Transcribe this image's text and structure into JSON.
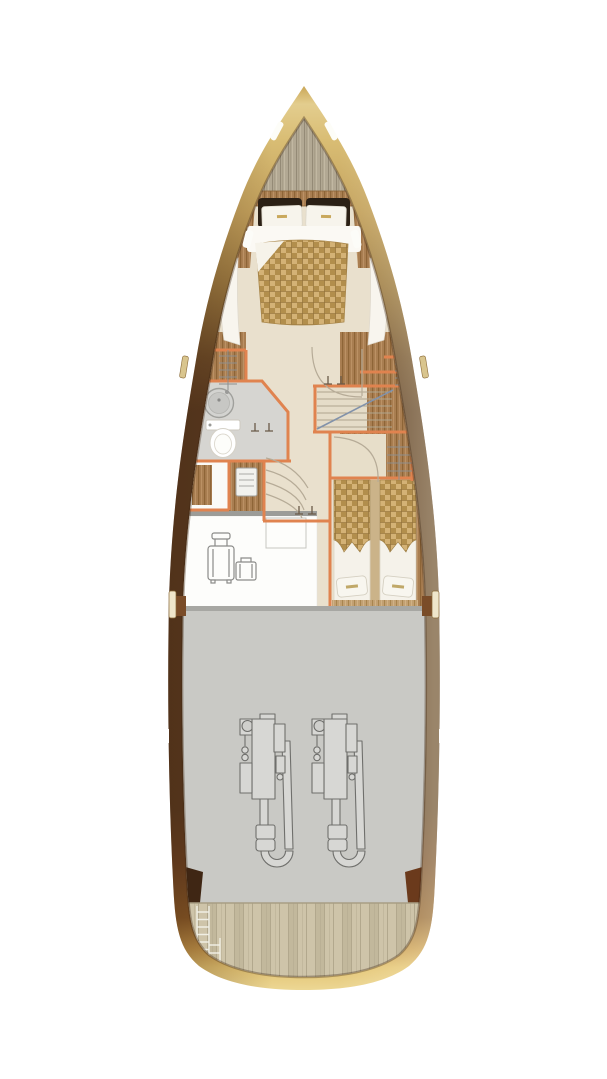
{
  "palette": {
    "hull_gold_light": "#e3cd8e",
    "hull_gold": "#c2a05c",
    "hull_bronze": "#9a7840",
    "hull_brown": "#573820",
    "stern_gold": "#e3c372",
    "partition_orange": "#e0834f",
    "wood_medium": "#a97e51",
    "wood_light": "#c2a072",
    "floor_beige": "#e9e0cd",
    "bathroom_gray": "#d6d5d1",
    "engine_room_gray": "#c9c9c5",
    "luggage_floor_white": "#fdfdfb",
    "teak_deck": "#cec4a9",
    "bow_deck_gray": "#b2a893",
    "blanket_weave_gold": "#c6a25f",
    "pillow_dark_brown": "#2b2015",
    "linen_white": "#f7f4ec"
  },
  "regions": [
    {
      "id": "bow-deck",
      "name": "bow deck"
    },
    {
      "id": "master-cabin",
      "name": "master cabin with double bed"
    },
    {
      "id": "bathroom",
      "name": "bathroom with sink and toilet"
    },
    {
      "id": "wardrobes",
      "name": "wardrobe with hanger rod"
    },
    {
      "id": "corridor",
      "name": "corridor with curved steps"
    },
    {
      "id": "staircase",
      "name": "staircase"
    },
    {
      "id": "twin-cabin",
      "name": "twin guest cabin"
    },
    {
      "id": "luggage-room",
      "name": "luggage room"
    },
    {
      "id": "engine-room",
      "name": "engine room with twin engines"
    },
    {
      "id": "stern-deck",
      "name": "stern teak deck with ladder"
    }
  ],
  "icons": [
    {
      "name": "sink-icon"
    },
    {
      "name": "toilet-icon"
    },
    {
      "name": "hanger-rod-icon"
    },
    {
      "name": "door-swing-icon"
    },
    {
      "name": "suitcase-icon"
    },
    {
      "name": "briefcase-icon"
    },
    {
      "name": "locker-icon"
    },
    {
      "name": "engine-icon"
    },
    {
      "name": "ladder-icon"
    },
    {
      "name": "hatch-icon"
    },
    {
      "name": "window-icon"
    }
  ]
}
